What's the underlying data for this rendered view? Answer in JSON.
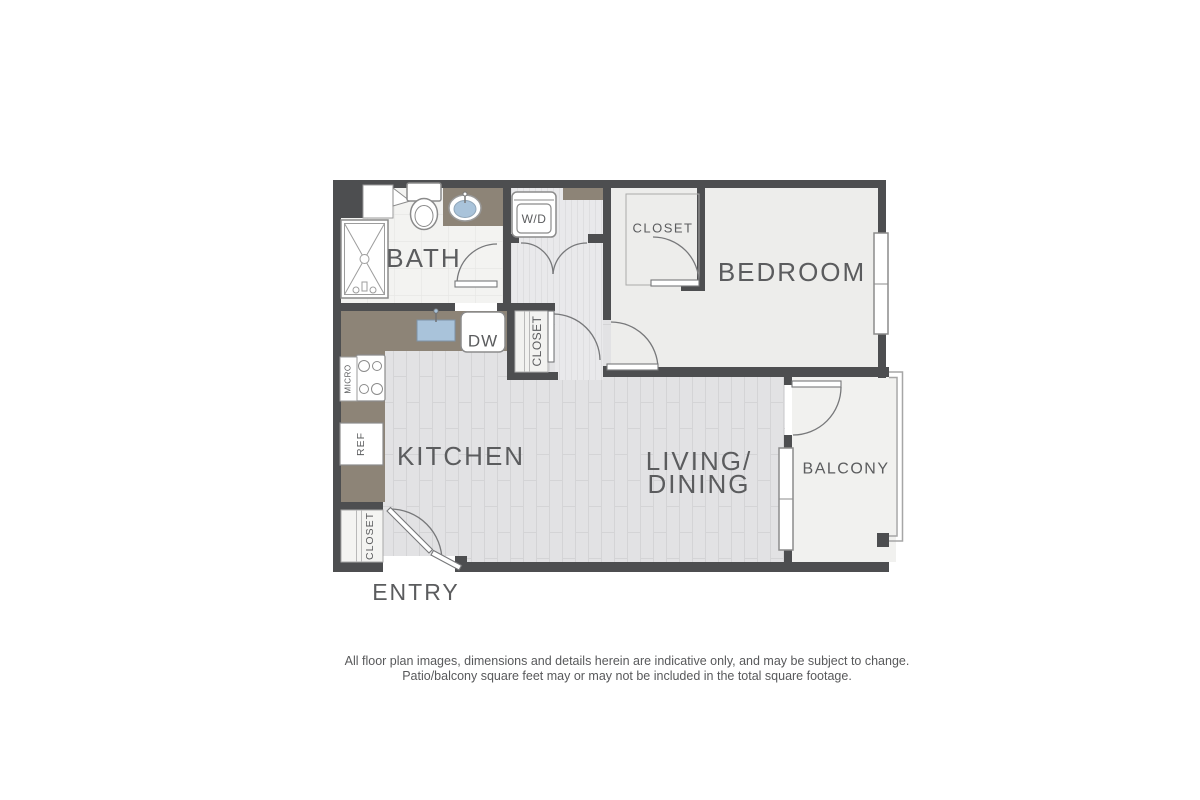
{
  "floor_plan": {
    "labels": {
      "bath": "BATH",
      "bedroom": "BEDROOM",
      "kitchen": "KITCHEN",
      "living_line1": "LIVING/",
      "living_line2": "DINING",
      "balcony": "BALCONY",
      "entry": "ENTRY",
      "closet_bedroom": "CLOSET",
      "closet_hall": "CLOSET",
      "closet_entry": "CLOSET",
      "washer_dryer": "W/D",
      "dishwasher": "DW",
      "microwave": "MICRO",
      "refrigerator": "REF"
    },
    "colors": {
      "wall": "#4d4e50",
      "counter": "#8d8477",
      "sink_blue": "#a9c3da",
      "bath_floor": "#f3f3f1",
      "hall_floor": "#e9e9eb",
      "plank_floor": "#e2e2e4",
      "bedroom_floor": "#ededeb",
      "balcony_floor": "#f1f1ef",
      "label_text": "#5b5c5e"
    }
  },
  "disclaimer": {
    "line1": "All floor plan images, dimensions and details herein are indicative only, and may be subject to change.",
    "line2": "Patio/balcony square feet may or may not be included in the total square footage."
  }
}
